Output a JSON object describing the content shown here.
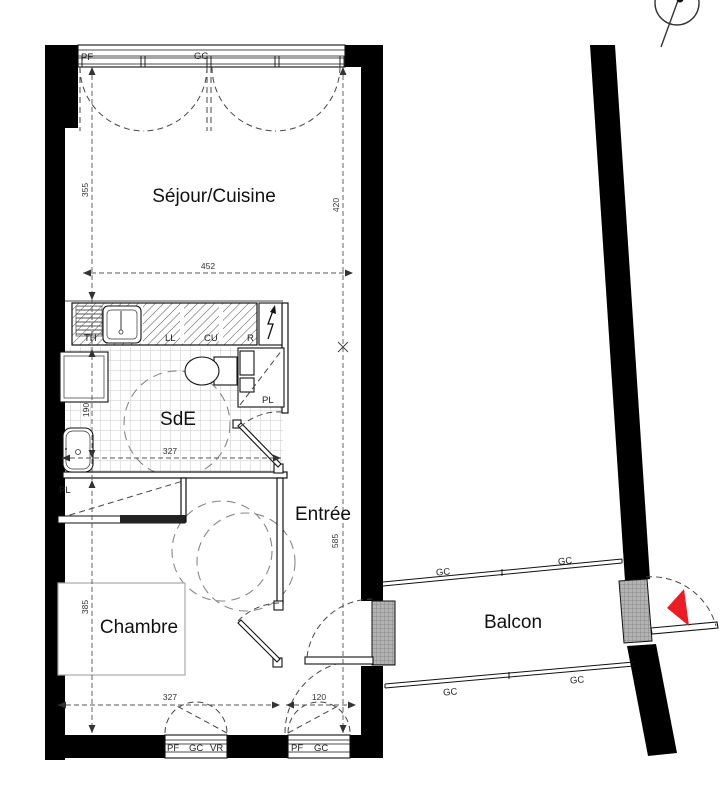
{
  "plan": {
    "title": "Apartment floor plan",
    "rooms": {
      "sejour": "Séjour/Cuisine",
      "sde": "SdE",
      "chambre": "Chambre",
      "entree": "Entrée",
      "balcon": "Balcon"
    },
    "kitchen": {
      "th": "TH",
      "ll": "LL",
      "cu": "CU",
      "r": "R"
    },
    "closets": {
      "sde_pl": "PL",
      "chambre_pl": "PL"
    },
    "windows": {
      "top": {
        "pf": "PF",
        "gc": "GC"
      },
      "bottom_left": {
        "pf": "PF",
        "gc": "GC",
        "vr": "VR"
      },
      "bottom_right": {
        "pf": "PF",
        "gc": "GC"
      }
    },
    "balcony_rails": {
      "top_left": "GC",
      "top_right": "GC",
      "bottom_left": "GC",
      "bottom_right": "GC"
    },
    "dimensions_cm": {
      "sejour_height_left": "355",
      "sejour_height_right": "420",
      "sejour_width": "452",
      "sde_width": "327",
      "sde_height": "190",
      "entree_height": "585",
      "chambre_height": "385",
      "chambre_width": "327",
      "entree_width": "120"
    },
    "colors": {
      "wall": "#000000",
      "entry_arrow": "#ec1c24"
    }
  }
}
